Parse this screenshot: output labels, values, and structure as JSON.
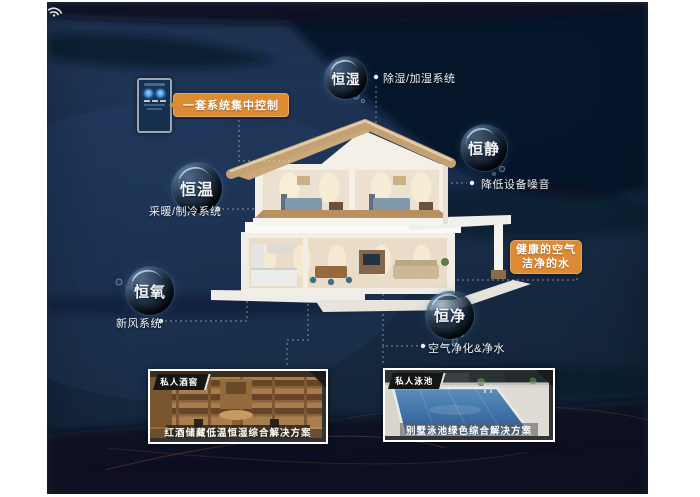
{
  "canvas": {
    "background_navy": "#16283F",
    "streak_dark": "#0A1420",
    "accent_orange": "#DC8B33",
    "text_light": "#EFF3F7"
  },
  "control": {
    "callout_label": "一套系统集中控制"
  },
  "bubbles": [
    {
      "id": "heng-shi",
      "label": "恒湿",
      "note": "除湿/加湿系统"
    },
    {
      "id": "heng-jing-quiet",
      "label": "恒静",
      "note": "降低设备噪音"
    },
    {
      "id": "heng-wen",
      "label": "恒温",
      "note": "采暖/制冷系统"
    },
    {
      "id": "heng-yang",
      "label": "恒氧",
      "note": "新风系统"
    },
    {
      "id": "heng-jing-clean",
      "label": "恒净",
      "note": "空气净化&净水"
    }
  ],
  "water_callout": {
    "line1": "健康的空气",
    "line2": "洁净的水"
  },
  "photo_cards": [
    {
      "tag": "私人酒窖",
      "caption": "红酒储藏低温恒湿综合解决方案"
    },
    {
      "tag": "私人泳池",
      "caption": "别墅泳池绿色综合解决方案"
    }
  ]
}
